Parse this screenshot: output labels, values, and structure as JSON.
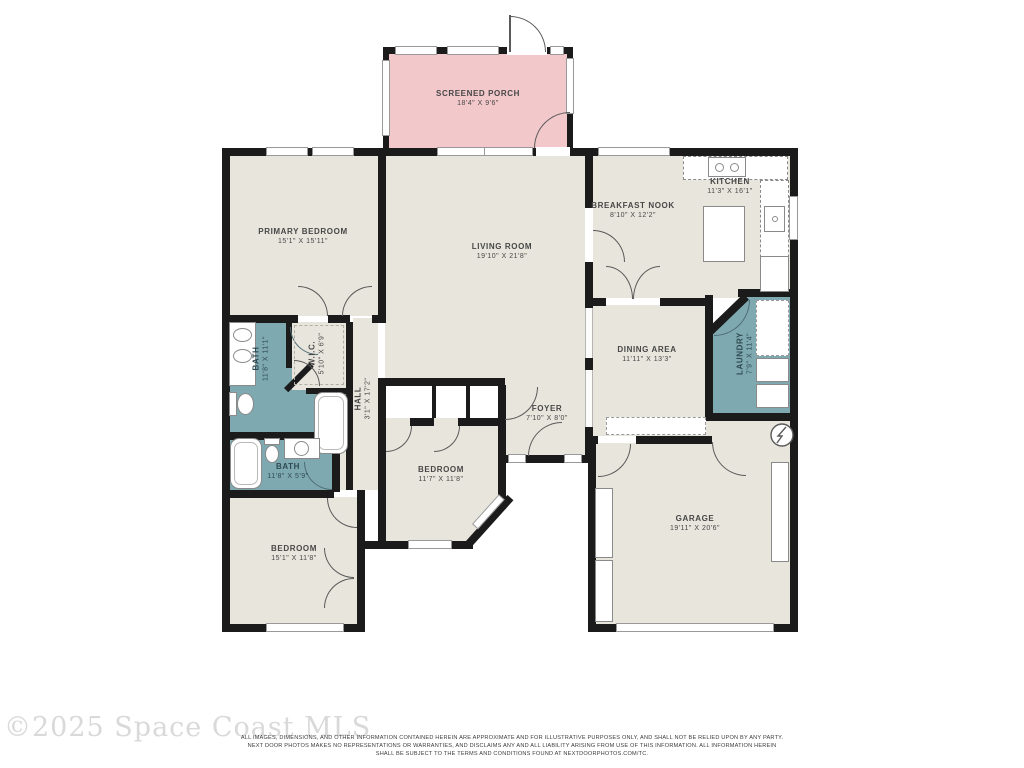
{
  "colors": {
    "wall": "#1b1b1b",
    "floor": "#e7e5dc",
    "porch_fill": "#f2c8cb",
    "wet_room_fill": "#7fa9b1",
    "fixture_outline": "#8a8a8a"
  },
  "rooms": {
    "screened_porch": {
      "name": "SCREENED PORCH",
      "dims": "18'4\" X 9'6\""
    },
    "primary_bedroom": {
      "name": "PRIMARY BEDROOM",
      "dims": "15'1\" X 15'11\""
    },
    "living_room": {
      "name": "LIVING ROOM",
      "dims": "19'10\" X 21'8\""
    },
    "breakfast_nook": {
      "name": "BREAKFAST NOOK",
      "dims": "8'10\" X 12'2\""
    },
    "kitchen": {
      "name": "KITCHEN",
      "dims": "11'3\" X 16'1\""
    },
    "dining_area": {
      "name": "DINING AREA",
      "dims": "11'11\" X 13'3\""
    },
    "laundry": {
      "name": "LAUNDRY",
      "dims": "7'9\" X 11'4\""
    },
    "primary_bath": {
      "name": "BATH",
      "dims": "11'8\" X 11'1\""
    },
    "wic": {
      "name": "W.I.C.",
      "dims": "5'10\" X 6'9\""
    },
    "hall": {
      "name": "HALL",
      "dims": "3'1\" X 17'2\""
    },
    "bath2": {
      "name": "BATH",
      "dims": "11'8\" X 5'9\""
    },
    "bedroom_middle": {
      "name": "BEDROOM",
      "dims": "11'7\" X 11'8\""
    },
    "foyer": {
      "name": "FOYER",
      "dims": "7'10\" X 8'0\""
    },
    "bedroom_left": {
      "name": "BEDROOM",
      "dims": "15'1\" X 11'8\""
    },
    "garage": {
      "name": "GARAGE",
      "dims": "19'11\" X 20'6\""
    }
  },
  "footer": {
    "watermark": "©2025 Space Coast MLS",
    "disclaimer_line1": "ALL IMAGES, DIMENSIONS, AND OTHER INFORMATION CONTAINED HEREIN ARE APPROXIMATE AND FOR ILLUSTRATIVE PURPOSES ONLY, AND SHALL NOT BE RELIED UPON BY ANY PARTY.",
    "disclaimer_line2": "NEXT DOOR PHOTOS MAKES NO REPRESENTATIONS OR WARRANTIES, AND DISCLAIMS ANY AND ALL LIABILITY ARISING FROM USE OF THIS INFORMATION. ALL INFORMATION HEREIN",
    "disclaimer_line3": "SHALL BE SUBJECT TO THE TERMS AND CONDITIONS FOUND AT NEXTDOORPHOTOS.COM/TC."
  }
}
